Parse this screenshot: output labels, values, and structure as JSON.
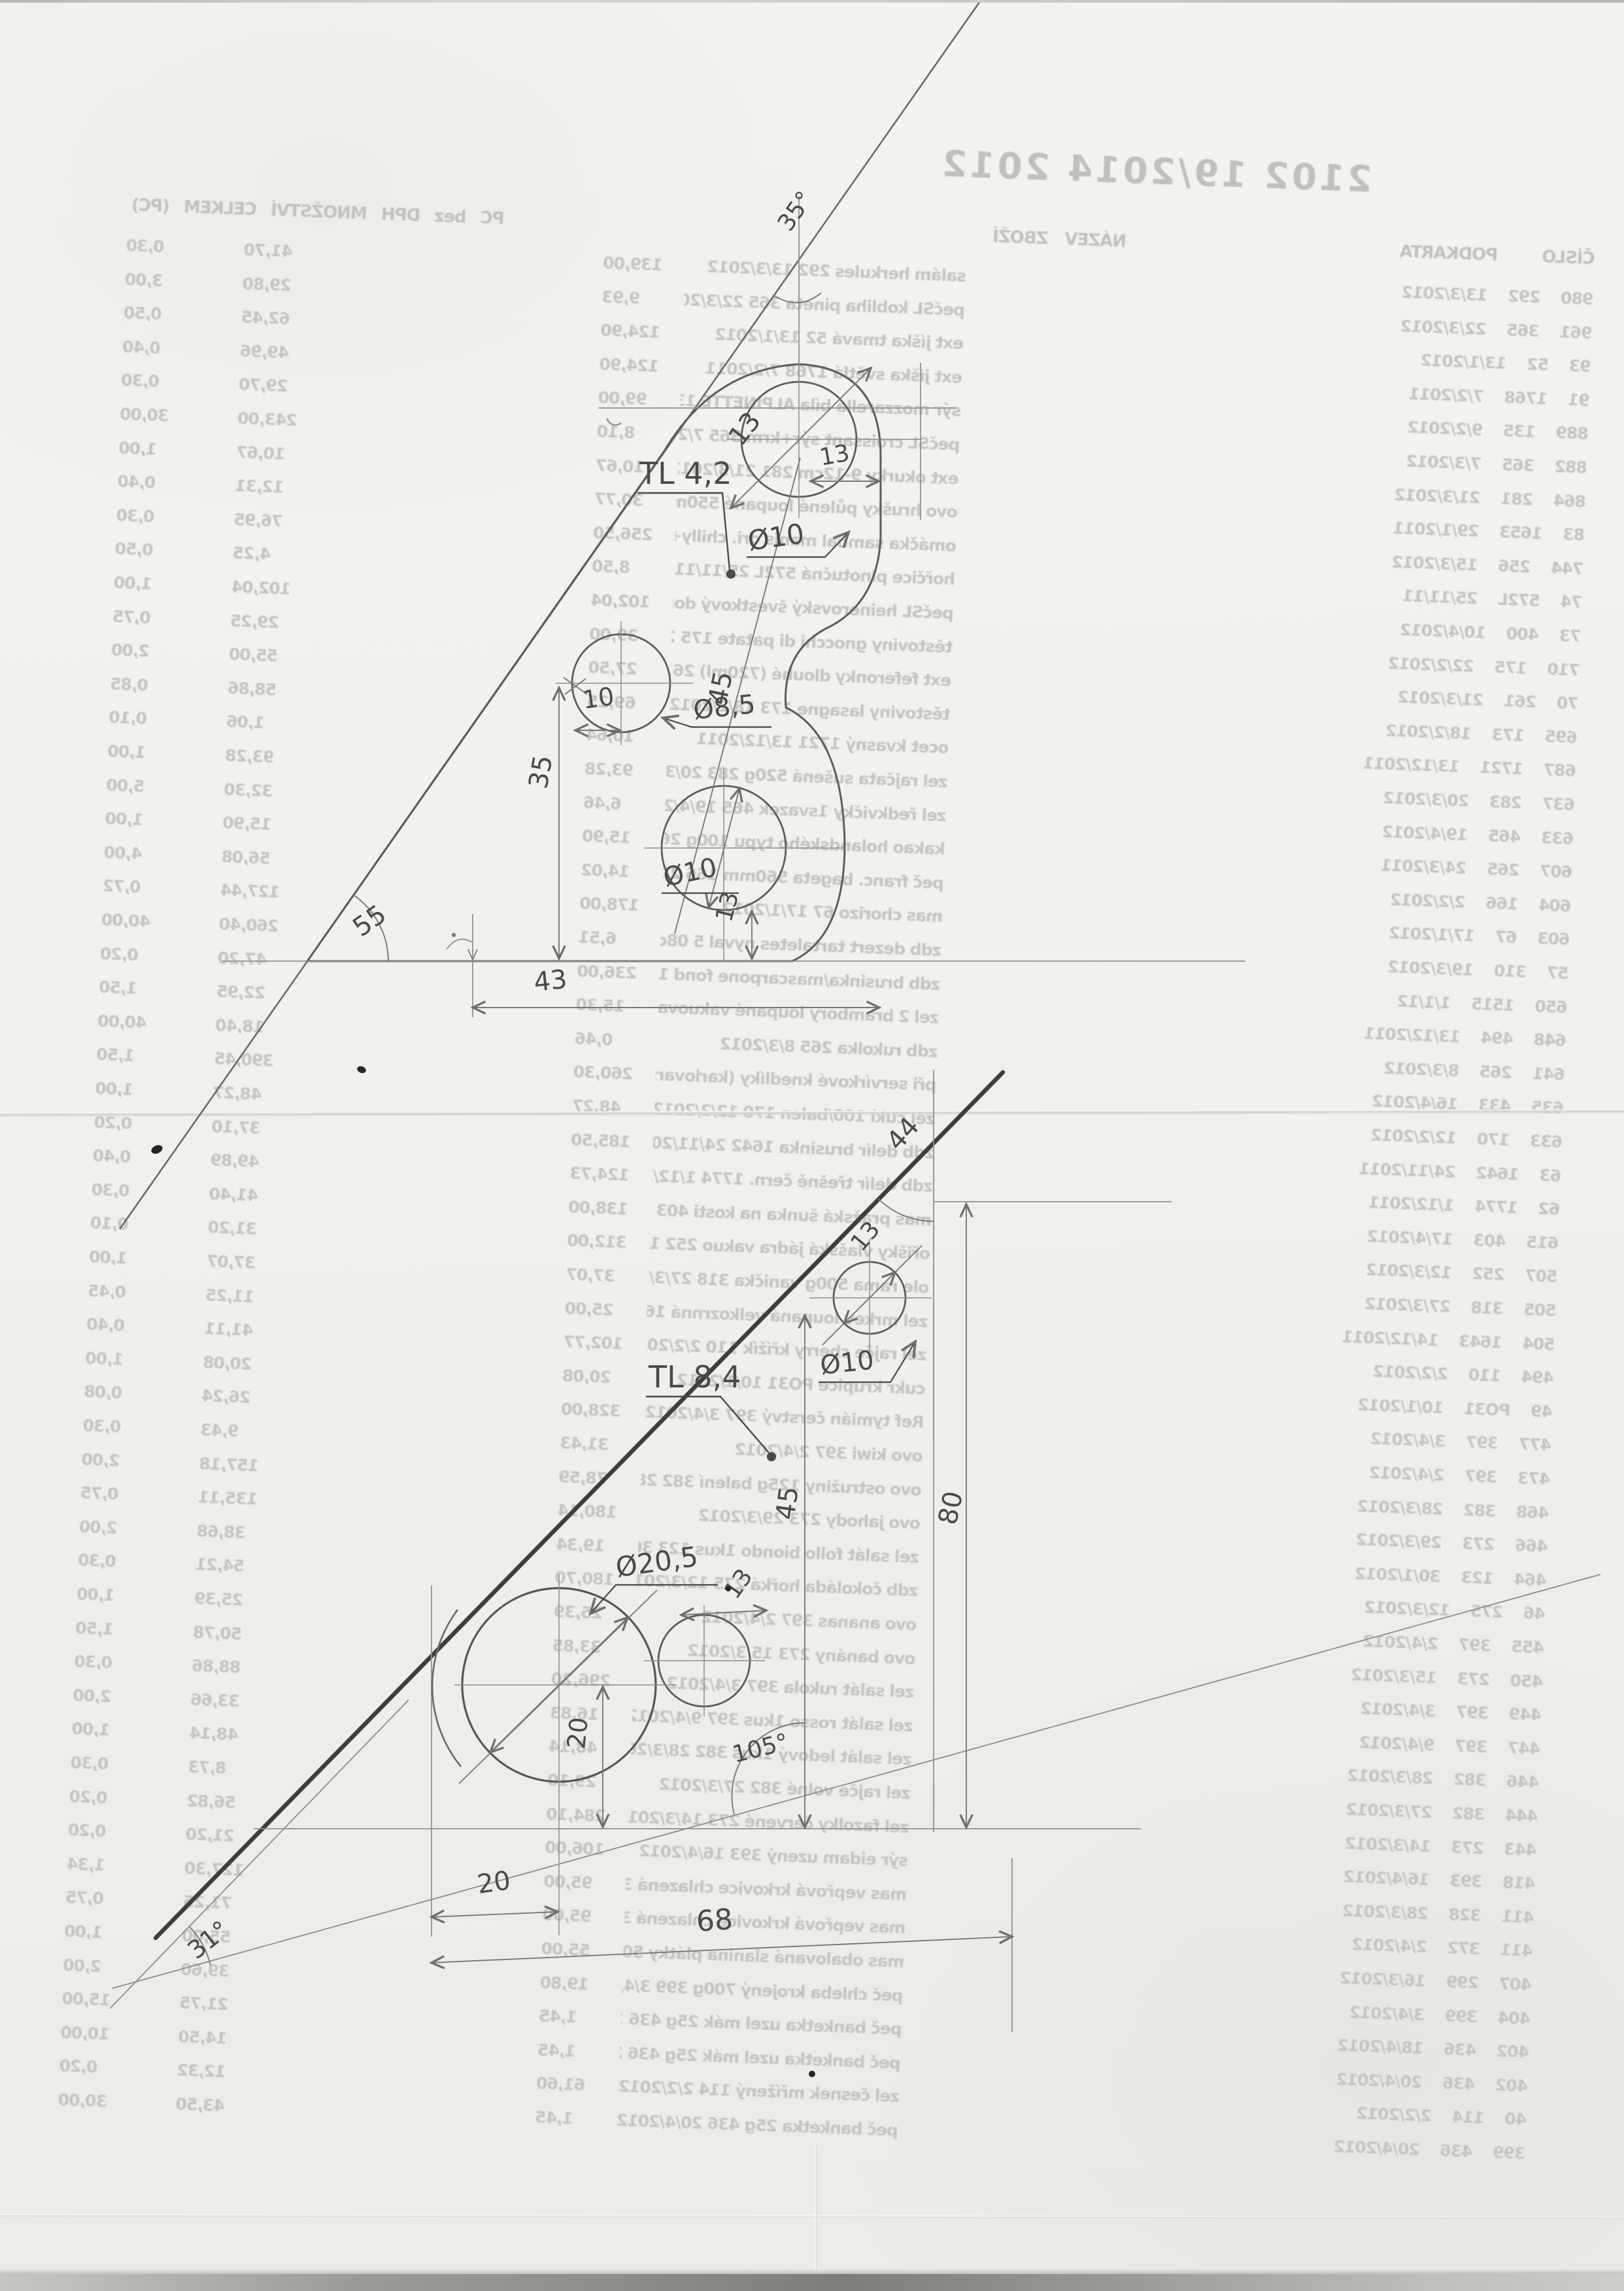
{
  "page": {
    "kind": "scanned sheet with hand-drawn part sketches over receipt bleed-through"
  },
  "receipt": {
    "title": "2102 19/2014 2012",
    "headers": {
      "codes": "ČÍSLO PODKARTA",
      "name": "NÁZEV ZBOŽÍ",
      "numbers": "PC bez DPH MNOŽSTVÍ CELKEM (PC)"
    },
    "rows": [
      {
        "code": "980 292 13/3/2012",
        "name": "salám herkules 292 13/3/2012",
        "price": "139,00",
        "qty": "0,30",
        "total": "41,70"
      },
      {
        "code": "961 365 22/3/2012",
        "name": "pečSL kobliha pineta 365 22/3/2012",
        "price": "9,93",
        "qty": "3,00",
        "total": "29,80"
      },
      {
        "code": "93 52 13/1/2012",
        "name": "ext jíška tmavá 52 13/1/2012",
        "price": "124,90",
        "qty": "0,50",
        "total": "62,45"
      },
      {
        "code": "91 1768 7/2/2011",
        "name": "ext jíška světlá 1768 7/2/2011",
        "price": "124,90",
        "qty": "0,40",
        "total": "49,96"
      },
      {
        "code": "889 135 9/2/2012",
        "name": "sýr mozzarella bíla ALPINETTE 135 9/2/20",
        "price": "99,00",
        "qty": "0,30",
        "total": "29,70"
      },
      {
        "code": "882 365 7/3/2012",
        "name": "pečSL croissant sýr+krm 365 7/2/2012",
        "price": "8,10",
        "qty": "30,00",
        "total": "243,00"
      },
      {
        "code": "864 281 21/3/2012",
        "name": "ext okurky 9-12cm 281 21/3/2012",
        "price": "10,67",
        "qty": "1,00",
        "total": "10,67"
      },
      {
        "code": "83 1653 29/1/2011",
        "name": "ovo hrušky půlené loupané 550ml 1653 29/",
        "price": "30,77",
        "qty": "0,40",
        "total": "12,31"
      },
      {
        "code": "744 256 15/3/2012",
        "name": "omáčka sambal manis ori. chilly+soja 250",
        "price": "256,50",
        "qty": "0,30",
        "total": "76,95"
      },
      {
        "code": "74 572L 25/11/11",
        "name": "hořčice plnotučná 572L 25/11/11",
        "price": "8,50",
        "qty": "0,50",
        "total": "4,25"
      },
      {
        "code": "73 400 10/4/2012",
        "name": "pečSL heinerovský švestkový dort s dro 4",
        "price": "102,04",
        "qty": "1,00",
        "total": "102,04"
      },
      {
        "code": "710 175 22/2/2012",
        "name": "těstoviny gnocchi di patate 175 22/2/201",
        "price": "39,00",
        "qty": "0,75",
        "total": "29,25"
      },
      {
        "code": "70 261 21/3/2012",
        "name": "ext feferonky dlouhé (720ml) 261 21/3/20",
        "price": "27,50",
        "qty": "2,00",
        "total": "55,00"
      },
      {
        "code": "695 173 18/2/2012",
        "name": "těstoviny lasagne 173 18/2/2012",
        "price": "69,25",
        "qty": "0,85",
        "total": "58,86"
      },
      {
        "code": "687 1721 13/12/2011",
        "name": "ocet kvasný 1721 13/12/2011",
        "price": "10,64",
        "qty": "0,10",
        "total": "1,06"
      },
      {
        "code": "637 283 20/3/2012",
        "name": "zel rajčata sušená 520g 283 20/3/2012",
        "price": "93,28",
        "qty": "1,00",
        "total": "93,28"
      },
      {
        "code": "633 465 19/4/2012",
        "name": "zel ředkvičky 1svazek 465 19/4/2012",
        "price": "6,46",
        "qty": "5,00",
        "total": "32,30"
      },
      {
        "code": "607 265 24/3/2011",
        "name": "kakao holandského typu 100g 265 24/3/201",
        "price": "15,90",
        "qty": "1,00",
        "total": "15,90"
      },
      {
        "code": "604 166 2/2/2012",
        "name": "peč franc. bageta 560mm 166 2/2/2012",
        "price": "14,02",
        "qty": "4,00",
        "total": "56,08"
      },
      {
        "code": "603 67 17/1/2012",
        "name": "mas chorizo 67 17/1/2012",
        "price": "178,00",
        "qty": "0,72",
        "total": "127,44"
      },
      {
        "code": "57 310 19/3/2012",
        "name": "zdb dezert tartaletes nyval 5 08cm 310",
        "price": "6,51",
        "qty": "40,00",
        "total": "260,40"
      },
      {
        "code": "650 1515 1/1/12",
        "name": "zdb brusinka/mascarpone fond 1515 1/1/12",
        "price": "236,00",
        "qty": "0,20",
        "total": "47,20"
      },
      {
        "code": "648 494 13/12/2011",
        "name": "zel 2 brambory loupané vakuované 494 13",
        "price": "15,30",
        "qty": "1,50",
        "total": "22,95"
      },
      {
        "code": "641 265 8/3/2012",
        "name": "zdb rukolka 265 8/3/2012",
        "price": "0,46",
        "qty": "40,00",
        "total": "18,40"
      },
      {
        "code": "635 433 16/4/2012",
        "name": "při servírkové knedlíky (karlovarské) 43",
        "price": "260,30",
        "qty": "1,50",
        "total": "390,45"
      },
      {
        "code": "633 170 12/2/2012",
        "name": "zel cukì 100/balen 170 12/2/2012",
        "price": "48,27",
        "qty": "1,00",
        "total": "48,27"
      },
      {
        "code": "63 1642 24/11/2011",
        "name": "zdb delír brusinka 1642 24/11/2011",
        "price": "185,50",
        "qty": "0,20",
        "total": "37,10"
      },
      {
        "code": "62 1774 1/12/2011",
        "name": "zdb delír třešně čern. 1774 1/12/2011",
        "price": "124,73",
        "qty": "0,40",
        "total": "49,89"
      },
      {
        "code": "615 403 17/4/2012",
        "name": "mas pražská šunka na kosti 403 17/4/2012",
        "price": "138,00",
        "qty": "0,30",
        "total": "41,40"
      },
      {
        "code": "507 252 12/3/2012",
        "name": "ořišky vlašská jádra vakuo 252 12/3/2012",
        "price": "312,00",
        "qty": "0,10",
        "total": "31,20"
      },
      {
        "code": "505 318 27/3/2012",
        "name": "ole rama 500g vanička 318 27/3/2012",
        "price": "37,07",
        "qty": "1,00",
        "total": "37,07"
      },
      {
        "code": "504 1643 14/12/2011",
        "name": "zel mrkev loupaná velkozrnná 1643 24/12/2",
        "price": "25,00",
        "qty": "0,45",
        "total": "11,25"
      },
      {
        "code": "494 110 2/2/2012",
        "name": "zel rajče cherry křížík 110 2/2/2012",
        "price": "102,77",
        "qty": "0,40",
        "total": "41,11"
      },
      {
        "code": "49 PO31 10/1/2012",
        "name": "cukr krupice PO31 10/1/2012",
        "price": "20,08",
        "qty": "1,00",
        "total": "20,08"
      },
      {
        "code": "477 397 3/4/2012",
        "name": "Ref tymián čerstvý 397 3/4/2012",
        "price": "328,00",
        "qty": "0,08",
        "total": "26,24"
      },
      {
        "code": "473 397 2/4/2012",
        "name": "ovo kiwi 397 2/4/2012",
        "price": "31,43",
        "qty": "0,30",
        "total": "9,43"
      },
      {
        "code": "468 382 28/3/2012",
        "name": "ovo ostružiny 125g balení 382 28/3/2012",
        "price": "78,59",
        "qty": "2,00",
        "total": "157,18"
      },
      {
        "code": "466 273 29/3/2012",
        "name": "ovo jahody 273 29/3/2012",
        "price": "180,14",
        "qty": "0,75",
        "total": "135,11"
      },
      {
        "code": "464 123 30/1/2012",
        "name": "zel salát follo biondo 1kus 123 30/1/201",
        "price": "19,34",
        "qty": "2,00",
        "total": "38,68"
      },
      {
        "code": "46 275 12/3/2012",
        "name": "zdb čokoláda hořká 275 12/3/2012",
        "price": "180,70",
        "qty": "0,30",
        "total": "54,21"
      },
      {
        "code": "455 397 2/4/2012",
        "name": "ovo ananas 397 2/4/2012",
        "price": "25,39",
        "qty": "1,00",
        "total": "25,39"
      },
      {
        "code": "450 273 15/3/2012",
        "name": "ovo banány 273 15/3/2012",
        "price": "33,85",
        "qty": "1,50",
        "total": "50,78"
      },
      {
        "code": "449 397 3/4/2012",
        "name": "zel salát rukola 397 3/4/2012",
        "price": "296,20",
        "qty": "0,30",
        "total": "88,86"
      },
      {
        "code": "447 397 9/4/2012",
        "name": "zel salát rosso 1kus 397 9/4/2012",
        "price": "16,83",
        "qty": "2,00",
        "total": "33,66"
      },
      {
        "code": "446 382 28/3/2012",
        "name": "zel salát ledový 1kus 382 28/3/2012",
        "price": "48,14",
        "qty": "1,00",
        "total": "48,14"
      },
      {
        "code": "444 382 27/3/2012",
        "name": "zel rajče volné 382 27/3/2012",
        "price": "29,10",
        "qty": "0,30",
        "total": "8,73"
      },
      {
        "code": "443 273 14/3/2012",
        "name": "zel fazolky červené 273 14/3/2012",
        "price": "284,10",
        "qty": "0,20",
        "total": "56,82"
      },
      {
        "code": "418 393 16/4/2012",
        "name": "sýr eidam uzený 393 16/4/2012",
        "price": "106,00",
        "qty": "0,20",
        "total": "21,20"
      },
      {
        "code": "411 328 28/3/2012",
        "name": "mas vepřová krkovice chlazená 328 28/3/2",
        "price": "95,00",
        "qty": "1,34",
        "total": "127,30"
      },
      {
        "code": "411 372 2/4/2012",
        "name": "mas vepřová krkovice chlazená 372 2/4/20",
        "price": "95,00",
        "qty": "0,75",
        "total": "71,25"
      },
      {
        "code": "407 299 16/3/2012",
        "name": "mas obalovaná slanina plátky 500g 299 16/3",
        "price": "55,00",
        "qty": "1,00",
        "total": "55,00"
      },
      {
        "code": "404 399 3/4/2012",
        "name": "peč chleba krojený 700g 399 3/4/2012",
        "price": "19,80",
        "qty": "2,00",
        "total": "39,60"
      },
      {
        "code": "402 436 18/4/2012",
        "name": "peč banketka uzel mák 25g 436 18/4/2012",
        "price": "1,45",
        "qty": "15,00",
        "total": "21,75"
      },
      {
        "code": "402 436 20/4/2012",
        "name": "peč banketka uzel mák 25g 436 20/4/2012",
        "price": "1,45",
        "qty": "10,00",
        "total": "14,50"
      },
      {
        "code": "40 114 2/2/2012",
        "name": "zel česnek mřížený 114 2/2/2012",
        "price": "61,60",
        "qty": "0,20",
        "total": "12,32"
      },
      {
        "code": "399 436 20/4/2012",
        "name": "peč banketka 25g 436 20/4/2012",
        "price": "1,45",
        "qty": "30,00",
        "total": "43,50"
      }
    ]
  },
  "sketch": {
    "plate1": {
      "thickness_label": "TL 4,2",
      "apex_angle": "35°",
      "base_angle": "55",
      "top_hole_dia": "Ø10",
      "top_hole_diag_dim": "13",
      "top_edge_dim": "13",
      "left_hole_dia": "Ø8,5",
      "left_offset_dim": "10",
      "height_dim": "35",
      "centers_dim": "45",
      "bottom_hole_dia": "Ø10",
      "bottom_gap_dim": "13",
      "base_dim": "43"
    },
    "plate2": {
      "thickness_label": "TL 8,4",
      "apex_angle": "44",
      "corner_angle": "31°",
      "cross_angle": "105°",
      "top_hole_dia": "Ø10",
      "top_hole_diag_dim": "13",
      "small_hole_dim": "13",
      "big_hole_dia": "Ø20,5",
      "big_hole_drop_dim": "20",
      "height_dim_a": "45",
      "height_dim_b": "80",
      "base_offset_dim": "20",
      "base_dim": "68"
    }
  }
}
